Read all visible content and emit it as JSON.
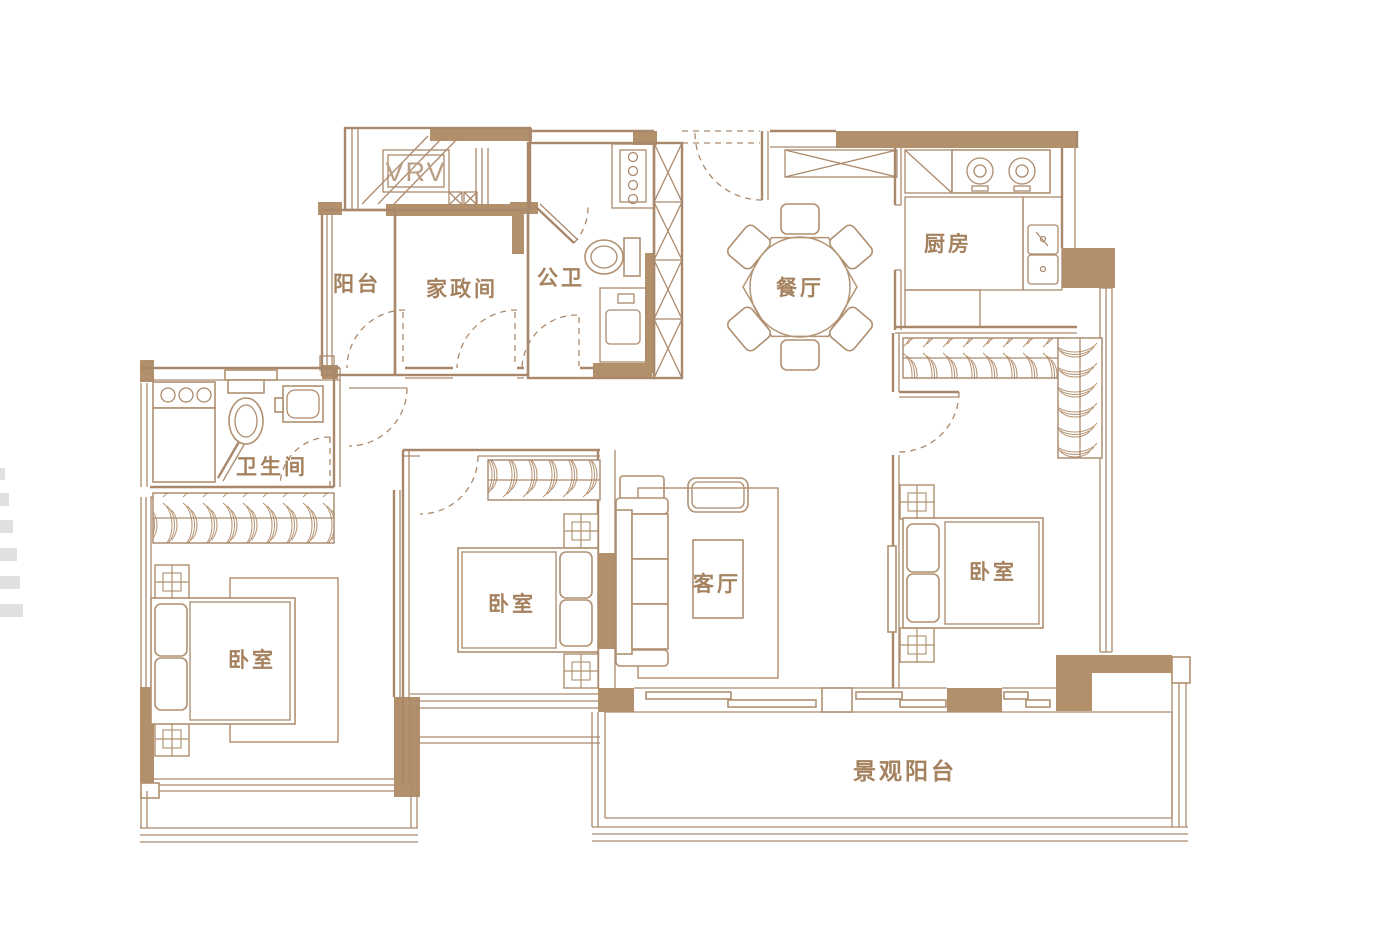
{
  "drawing": {
    "kind": "apartment-floor-plan",
    "colors": {
      "wall_fill": "#b3906c",
      "line": "#a8876a",
      "furniture_line": "#b59373",
      "label_text": "#a5825f",
      "watermark": "#e0e0e0"
    },
    "rooms": {
      "vrv_platform": {
        "label": "VRV"
      },
      "balcony_small": {
        "label": "阳台"
      },
      "laundry": {
        "label": "家政间"
      },
      "guest_bath": {
        "label": "公卫"
      },
      "dining": {
        "label": "餐厅"
      },
      "kitchen": {
        "label": "厨房"
      },
      "bathroom": {
        "label": "卫生间"
      },
      "bedroom_left": {
        "label": "卧室"
      },
      "bedroom_middle": {
        "label": "卧室"
      },
      "living": {
        "label": "客厅"
      },
      "bedroom_right": {
        "label": "卧室"
      },
      "view_balcony": {
        "label": "景观阳台"
      }
    }
  }
}
